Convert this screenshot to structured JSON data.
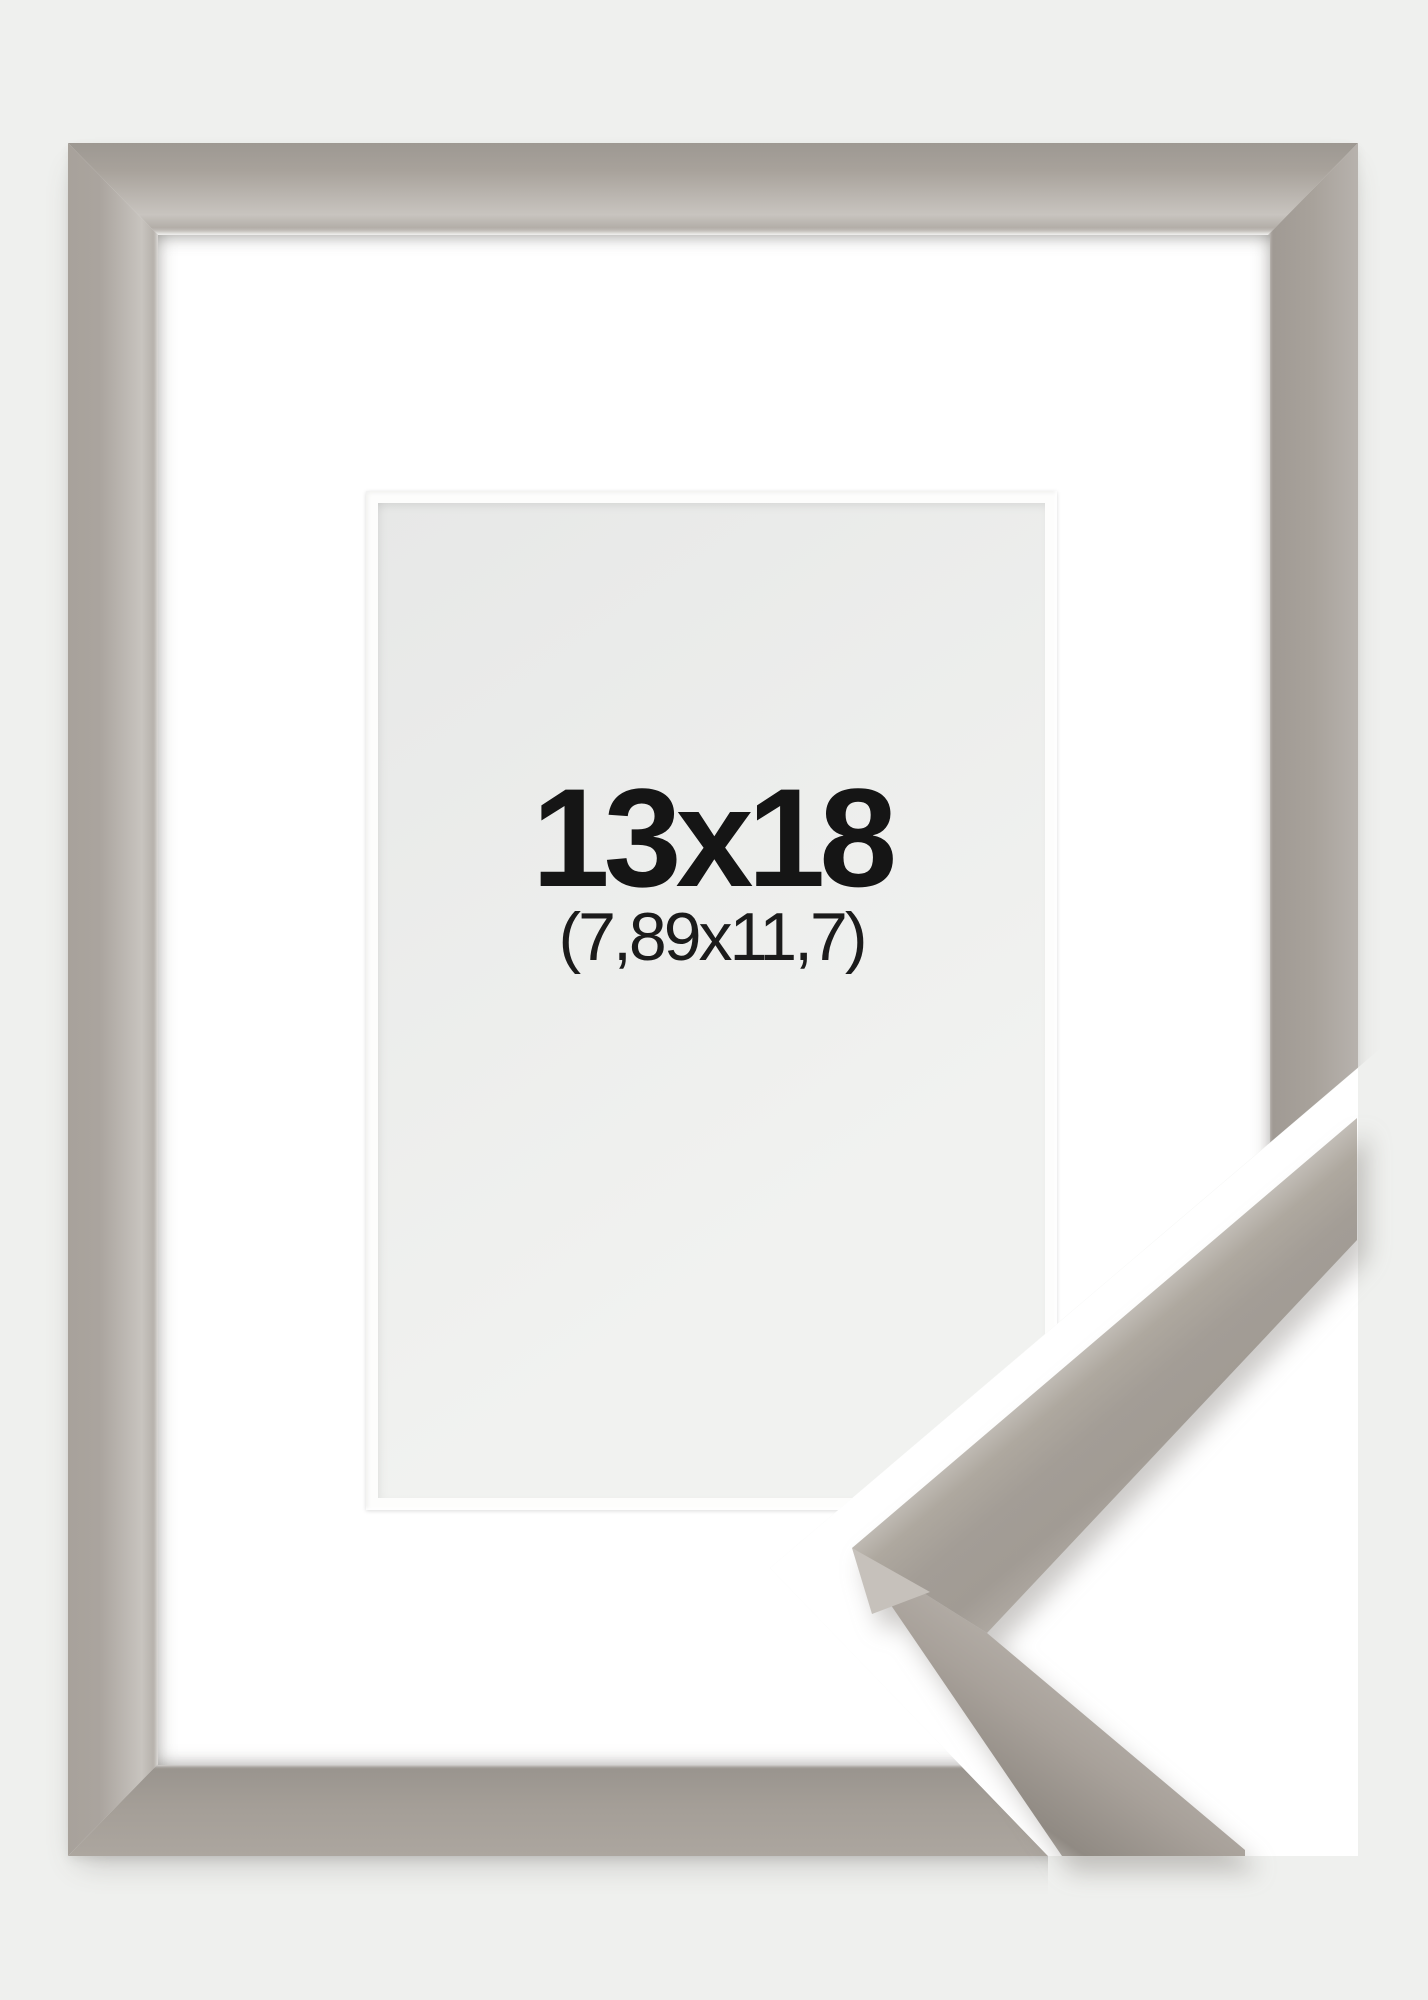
{
  "frame": {
    "size_label": "13x18",
    "inner_size_label": "(7,89x11,7)"
  },
  "theme": {
    "bg": "#eff0ee",
    "mat": "#ffffff",
    "cut-white": "#ffffff",
    "aperture-light": "#f1f2f0",
    "aperture-dark": "#e7e8e7",
    "text": "#151515",
    "m-base": "#a8a29b",
    "m-dark": "#9d9892",
    "m-light": "#c8c4bf",
    "m-lighter": "#d6d3cf"
  }
}
